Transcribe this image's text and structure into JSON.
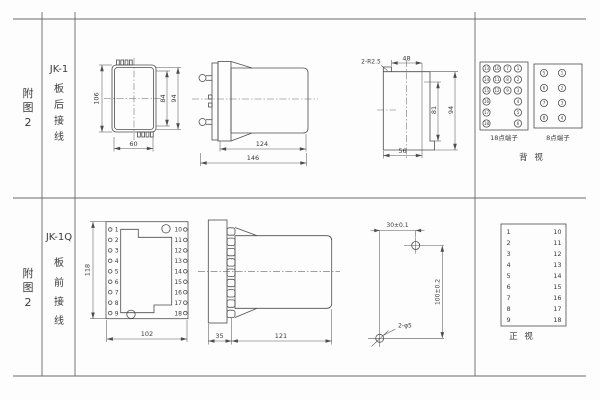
{
  "colors": {
    "background": "#fdfdfd",
    "line": "#4d4d4d",
    "text": "#3a3a3a"
  },
  "left_header": {
    "top": {
      "fig_chars": [
        "附",
        "图",
        "2"
      ],
      "model": "JK-1",
      "wiring_chars": [
        "板",
        "后",
        "接",
        "线"
      ]
    },
    "bottom": {
      "fig_chars": [
        "附",
        "图",
        "2"
      ],
      "model": "JK-1Q",
      "wiring_chars": [
        "板",
        "前",
        "接",
        "线"
      ]
    }
  },
  "jk1_rear": {
    "front_view": {
      "dim_height_outer": "106",
      "dim_height_inner": "84",
      "dim_height_mid": "94",
      "dim_width": "60"
    },
    "side_view": {
      "dim_body": "124",
      "dim_total": "146"
    },
    "panel_cutout": {
      "corner_radius_label": "2-R2.5",
      "dim_top_width": "48",
      "dim_inner_height": "81",
      "dim_outer_height": "94",
      "dim_bottom_width": "56"
    },
    "terminal_block_18": {
      "label": "18点端子",
      "grid": [
        [
          "13",
          "10",
          "7",
          "1"
        ],
        [
          "14",
          "11",
          "8",
          "2"
        ],
        [
          "15",
          "12",
          "9",
          "3"
        ],
        [
          "16",
          "",
          "",
          "4"
        ],
        [
          "17",
          "",
          "",
          "5"
        ],
        [
          "18",
          "",
          "",
          "6"
        ]
      ]
    },
    "terminal_block_8": {
      "label": "8点端子",
      "grid": [
        [
          "5",
          "1"
        ],
        [
          "6",
          "2"
        ],
        [
          "7",
          "3"
        ],
        [
          "8",
          "4"
        ]
      ]
    },
    "view_label": "背  视"
  },
  "jk1q_front": {
    "front_view": {
      "dim_height": "118",
      "dim_width": "102",
      "left_terminals": [
        "1",
        "2",
        "3",
        "4",
        "5",
        "6",
        "7",
        "8",
        "9"
      ],
      "right_terminals": [
        "10",
        "11",
        "12",
        "13",
        "14",
        "15",
        "16",
        "17",
        "18"
      ]
    },
    "side_view": {
      "dim_plate": "35",
      "dim_body": "121"
    },
    "drill_pattern": {
      "dim_horizontal": "30±0.1",
      "dim_vertical": "100±0.2",
      "hole_label": "2-φ5"
    },
    "terminal_list": {
      "left": [
        "1",
        "2",
        "3",
        "4",
        "5",
        "6",
        "7",
        "8",
        "9"
      ],
      "right": [
        "10",
        "11",
        "12",
        "13",
        "14",
        "15",
        "16",
        "17",
        "18"
      ],
      "view_label": "正  视"
    }
  }
}
